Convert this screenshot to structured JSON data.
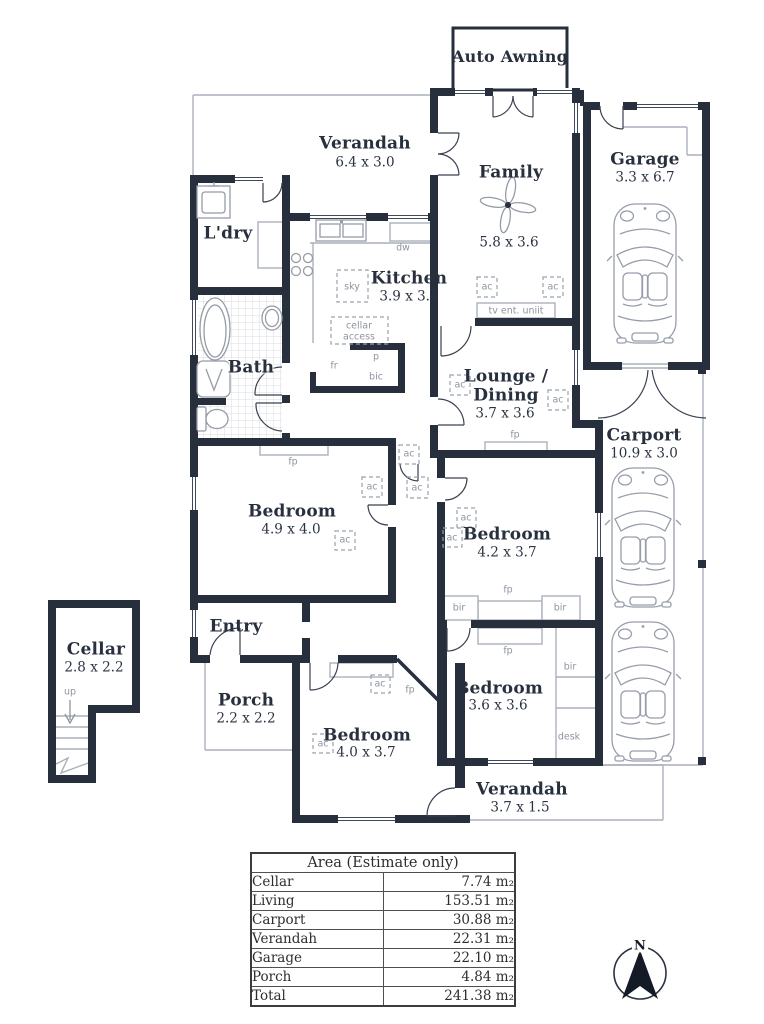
{
  "colors": {
    "wall": "#272e3c",
    "thin_outline": "#aab0bb",
    "fixture_stroke": "#959ba7",
    "tag_text": "#8e949f",
    "room_text": "#28303e",
    "tile": "#d8dbe0"
  },
  "rooms": {
    "auto_awning": {
      "name": "Auto Awning"
    },
    "verandah_top": {
      "name": "Verandah",
      "dim": "6.4 x 3.0"
    },
    "family": {
      "name": "Family",
      "dim": "5.8 x 3.6"
    },
    "garage": {
      "name": "Garage",
      "dim": "3.3 x 6.7"
    },
    "laundry": {
      "name": "L'dry"
    },
    "kitchen": {
      "name": "Kitchen",
      "dim": "3.9 x 3.4"
    },
    "bath": {
      "name": "Bath"
    },
    "lounge_dining": {
      "name_line1": "Lounge /",
      "name_line2": "Dining",
      "dim": "3.7 x 3.6"
    },
    "carport": {
      "name": "Carport",
      "dim": "10.9 x 3.0"
    },
    "bedroom_main": {
      "name": "Bedroom",
      "dim": "4.9 x 4.0"
    },
    "entry": {
      "name": "Entry"
    },
    "bedroom_2": {
      "name": "Bedroom",
      "dim": "4.2 x 3.7"
    },
    "cellar": {
      "name": "Cellar",
      "dim": "2.8 x 2.2"
    },
    "porch": {
      "name": "Porch",
      "dim": "2.2 x 2.2"
    },
    "bedroom_3": {
      "name": "Bedroom",
      "dim": "4.0 x 3.7"
    },
    "bedroom_4": {
      "name": "Bedroom",
      "dim": "3.6 x 3.6"
    },
    "verandah_bottom": {
      "name": "Verandah",
      "dim": "3.7 x 1.5"
    }
  },
  "fixtures": {
    "ac": "ac",
    "fp": "fp",
    "bir": "bir",
    "desk": "desk",
    "sky": "sky",
    "dw": "dw",
    "fridge": "fr",
    "pantry": "p",
    "bic": "bic",
    "cellar_access_line1": "cellar",
    "cellar_access_line2": "access",
    "tv_unit": "tv ent. uniit",
    "up": "up"
  },
  "compass": {
    "north": "N"
  },
  "area_table": {
    "title": "Area (Estimate only)",
    "rows": [
      {
        "label": "Cellar",
        "value": "7.74 m₂"
      },
      {
        "label": "Living",
        "value": "153.51 m₂"
      },
      {
        "label": "Carport",
        "value": "30.88 m₂"
      },
      {
        "label": "Verandah",
        "value": "22.31 m₂"
      },
      {
        "label": "Garage",
        "value": "22.10 m₂"
      },
      {
        "label": "Porch",
        "value": "4.84 m₂"
      },
      {
        "label": "Total",
        "value": "241.38 m₂"
      }
    ]
  }
}
